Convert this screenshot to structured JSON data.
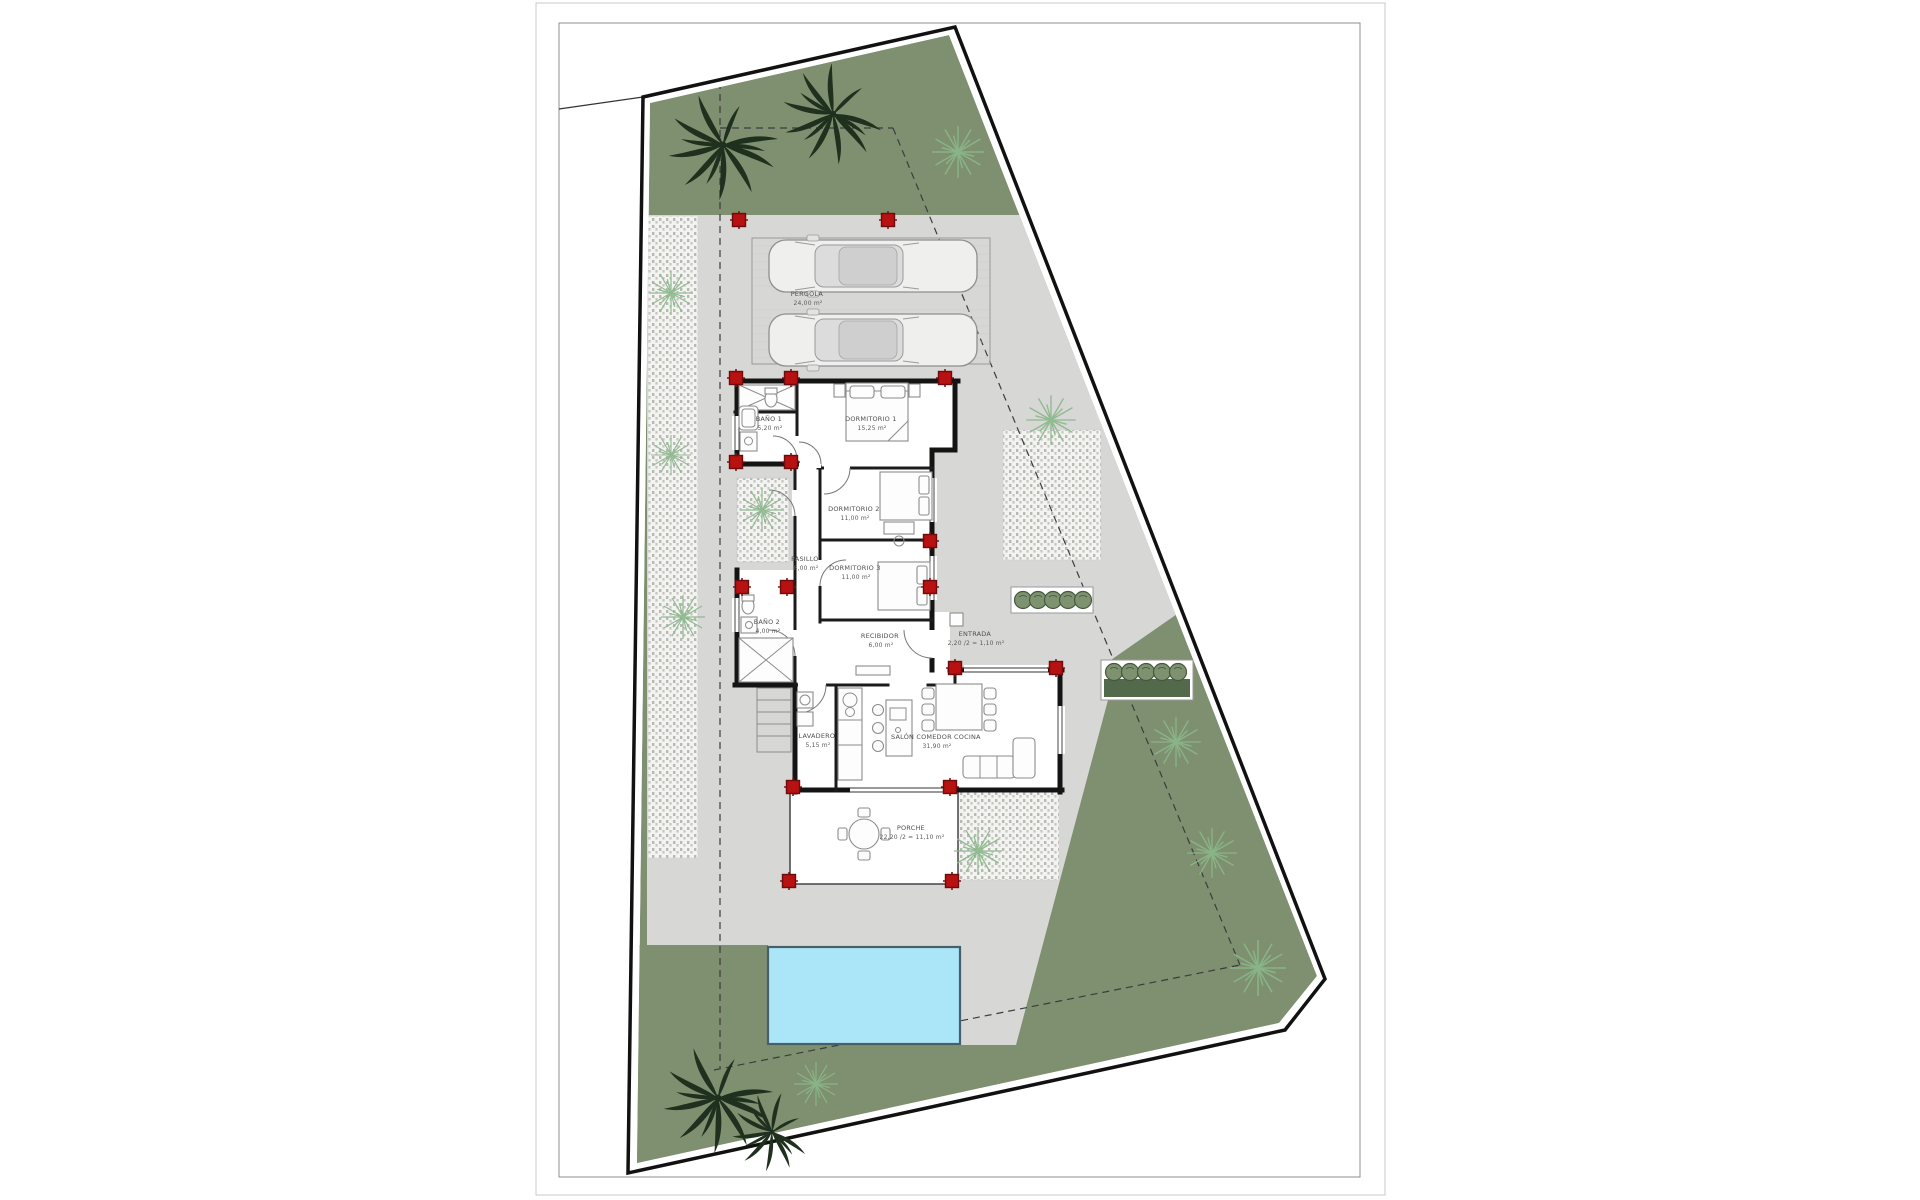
{
  "colors": {
    "garden": "#7e9070",
    "paving": "#d7d7d6",
    "pool": "#abe6f8",
    "pillar": "#b81111",
    "hedge": "#53694b",
    "plant_dark": "#20301e",
    "fern": "#8ab88a",
    "bush": "#7e9270"
  },
  "rooms": [
    {
      "name": "PERGOLA",
      "area": "24,00 m²"
    },
    {
      "name": "DORMITORIO 1",
      "area": "15,25 m²"
    },
    {
      "name": "BAÑO 1",
      "area": "5,20 m²"
    },
    {
      "name": "DORMITORIO 2",
      "area": "11,00 m²"
    },
    {
      "name": "PASILLO",
      "area": "8,00 m²"
    },
    {
      "name": "DORMITORIO 3",
      "area": "11,00 m²"
    },
    {
      "name": "BAÑO 2",
      "area": "4,00 m²"
    },
    {
      "name": "RECIBIDOR",
      "area": "6,00 m²"
    },
    {
      "name": "ENTRADA",
      "area": "2,20 /2 = 1,10 m²"
    },
    {
      "name": "LAVADERO",
      "area": "5,15 m²"
    },
    {
      "name": "SALÓN COMEDOR COCINA",
      "area": "31,90 m²"
    },
    {
      "name": "PORCHE",
      "area": "22,20 /2 = 11,10 m²"
    }
  ]
}
